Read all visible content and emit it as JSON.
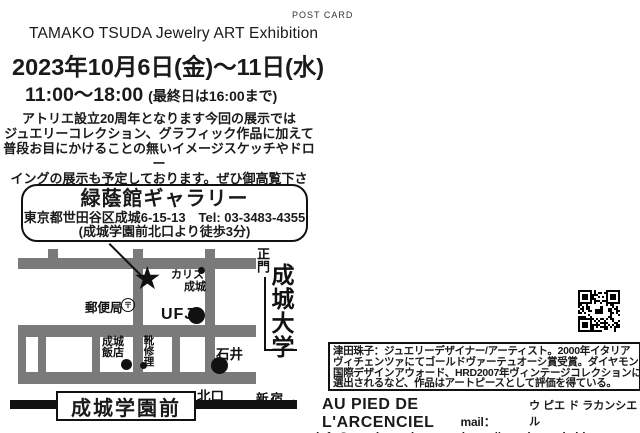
{
  "header": {
    "post_card": "POST CARD",
    "title": "TAMAKO TSUDA  Jewelry ART Exhibition",
    "date": "2023年10月6日(金)～11日(水)",
    "time": "11:00～18:00",
    "time_note": "(最終日は16:00まで)"
  },
  "intro": {
    "lines": [
      "アトリエ設立20周年となります今回の展示では",
      "ジュエリーコレクション、グラフィック作品に加えて",
      "普段お目にかけることの無いイメージスケッチやドロー",
      "イングの展示も予定しております。ぜひ御高覧下さい。"
    ]
  },
  "venue": {
    "name": "緑蔭館ギャラリー",
    "address_tel": "東京都世田谷区成城6-15-13　Tel: 03-3483-4355",
    "access": "(成城学園前北口より徒歩3分)"
  },
  "map": {
    "star": "★",
    "karisu_line1": "カリス",
    "karisu_line2": "成城",
    "post_office": "郵便局",
    "postal_mark": "〒",
    "bank": "UFJ",
    "hanten_line1": "成城",
    "hanten_line2": "飯店",
    "shoe_repair": "靴修理",
    "ishii": "石井",
    "north_exit": "北口",
    "shinjuku": "新宿→",
    "main_gate": "正門",
    "university": "成城大学",
    "station": "成城学園前"
  },
  "bio": {
    "lines": [
      "津田珠子：ジュエリーデザイナー/アーティスト。2000年イタリア",
      "ヴィチェンツァにてゴールドヴァーテュオーシ賞受賞。ダイヤモンドの",
      "国際デザインアウォード、HRD2007年ヴィンテージコレクションに",
      "選出されるなど、作品はアートピースとして評価を得ている。"
    ]
  },
  "contact": {
    "shop_name": "AU PIED DE L'ARCENCIEL",
    "shop_kana": "ウ ピエ ド ラカンシエル",
    "mail_label": "mail：",
    "email": "info@tamakotsuda.com",
    "url": "https://tamakotsuda.blogspot.com"
  },
  "colors": {
    "road": "#7a7a7a",
    "ink": "#111111"
  }
}
